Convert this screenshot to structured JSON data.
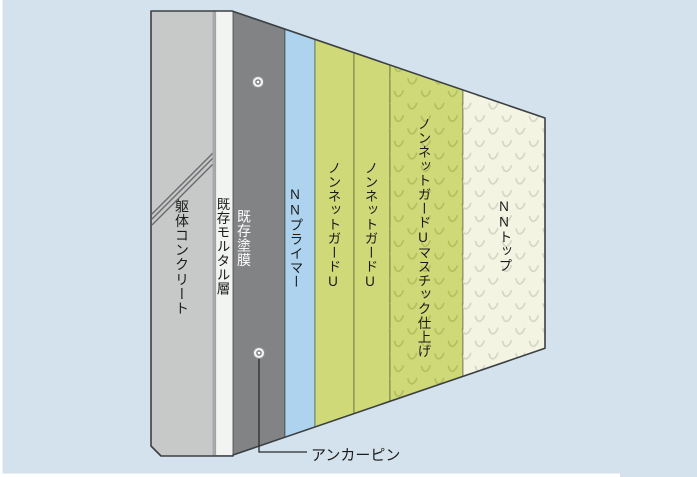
{
  "background_color": "#d4e2ed",
  "frame_color": "#ffffff",
  "diagram": {
    "type": "wall-coating-system-cross-section",
    "layers": [
      {
        "id": "concrete",
        "label": "躯体コンクリート",
        "color": "#c7c9c9",
        "text_color": "#1b1b1b"
      },
      {
        "id": "concrete-edge",
        "label": "",
        "color": "#a7a9ab"
      },
      {
        "id": "mortar",
        "label": "既存モルタル層",
        "color": "#f3f3f1",
        "text_color": "#1b1b1b"
      },
      {
        "id": "coating",
        "label": "既存塗膜",
        "color": "#828385",
        "text_color": "#ffffff"
      },
      {
        "id": "primer",
        "label": "NNプライマー",
        "color": "#aed3ef",
        "text_color": "#1b1b1b"
      },
      {
        "id": "guard1",
        "label": "ノンネットガードU",
        "color": "#cfd977",
        "text_color": "#1b1b1b"
      },
      {
        "id": "guard2",
        "label": "ノンネットガードU",
        "color": "#cfd977",
        "text_color": "#1b1b1b"
      },
      {
        "id": "mastic",
        "label": "ノンネットガードUマスチック仕上げ",
        "color": "#cfd977",
        "texture": "v-marks",
        "texture_color": "#b4bf60",
        "text_color": "#1b1b1b"
      },
      {
        "id": "top",
        "label": "NNトップ",
        "color": "#f3f4e2",
        "texture": "v-marks",
        "texture_color": "#d6d6ca",
        "text_color": "#1b1b1b"
      }
    ],
    "callout": {
      "label": "アンカーピン",
      "line_color": "#2b2b2b",
      "pin_count": 2
    },
    "outline_color": "#3c4043",
    "hatch_color": "#6a6c6e"
  }
}
